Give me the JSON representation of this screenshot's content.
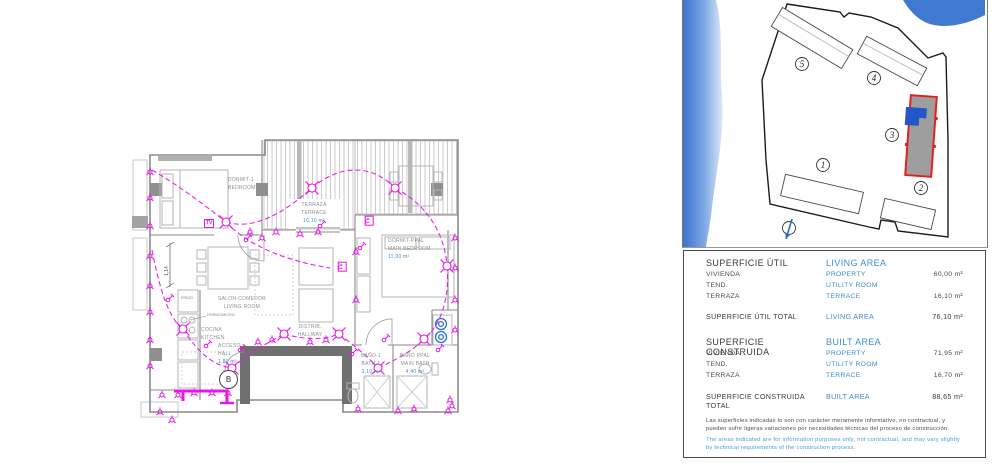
{
  "floor_plan": {
    "rooms": [
      {
        "es": "DORMIT-1",
        "en": "BEDROOM-1",
        "area": ""
      },
      {
        "es": "TERRAZA",
        "en": "TERRACE",
        "area": "16,10 m²"
      },
      {
        "es": "DORMIT-PPAL",
        "en": "MAIN BEDROOM",
        "area": "11,00 m²"
      },
      {
        "es": "SALON-COMEDOR",
        "en": "LIVING ROOM",
        "area": ""
      },
      {
        "es": "COCINA",
        "en": "KITCHEN",
        "area": ""
      },
      {
        "es": "ACCESO",
        "en": "HALL",
        "area": "1,80 m²"
      },
      {
        "es": "DISTRIB.",
        "en": "HALLWAY",
        "area": ""
      },
      {
        "es": "BAÑO-1",
        "en": "BATH-1",
        "area": "3,10 m²"
      },
      {
        "es": "BAÑO PPAL",
        "en": "MAIN BATH",
        "area": "4,40 m²"
      }
    ],
    "annotations": {
      "tv_label": "TV",
      "dimension": "1,14",
      "entrance_label": "B",
      "fridge_label": "FRIGO",
      "oven_label": "HORNO/MICRO."
    },
    "colors": {
      "electrical": "#e816e8",
      "walls": "#8a8a8a",
      "area_text": "#3e8ecb"
    }
  },
  "site_plan": {
    "buildings": [
      {
        "label": "1"
      },
      {
        "label": "2"
      },
      {
        "label": "3",
        "highlighted": true
      },
      {
        "label": "4"
      },
      {
        "label": "5"
      }
    ],
    "colors": {
      "water": "#3a74cc",
      "highlight_border": "#e32020",
      "highlight_fill": "#9e9e9e",
      "unit_marker": "#2257c9"
    }
  },
  "areas_table": {
    "util": {
      "title_es": "SUPERFICIE ÚTIL",
      "title_en": "LIVING AREA",
      "rows": [
        {
          "es": "VIVIENDA",
          "en": "PROPERTY",
          "val": "60,00 m²"
        },
        {
          "es": "TEND.",
          "en": "UTILITY ROOM",
          "val": ""
        },
        {
          "es": "TERRAZA",
          "en": "TERRACE",
          "val": "16,10 m²"
        }
      ],
      "total": {
        "es": "SUPERFICIE ÚTIL TOTAL",
        "en": "LIVING AREA",
        "val": "76,10 m²"
      }
    },
    "construida": {
      "title_es": "SUPERFICIE CONSTRUIDA",
      "title_en": "BUILT AREA",
      "rows": [
        {
          "es": "VIVIENDA",
          "en": "PROPERTY",
          "val": "71,95 m²"
        },
        {
          "es": "TEND.",
          "en": "UTILITY ROOM",
          "val": ""
        },
        {
          "es": "TERRAZA",
          "en": "TERRACE",
          "val": "16,70 m²"
        }
      ],
      "total": {
        "es": "SUPERFICIE CONSTRUIDA TOTAL",
        "en": "BUILT AREA",
        "val": "88,65 m²"
      }
    },
    "disclaimer_es": "Las superficies indicadas lo son con carácter meramente informativo, no contractual, y pueden sufrir ligeras variaciones por necesidades técnicas del proceso de construcción.",
    "disclaimer_en": "The areas indicated are for information purposes only, not contractual, and may vary slightly by technical requirements of the construction process."
  }
}
